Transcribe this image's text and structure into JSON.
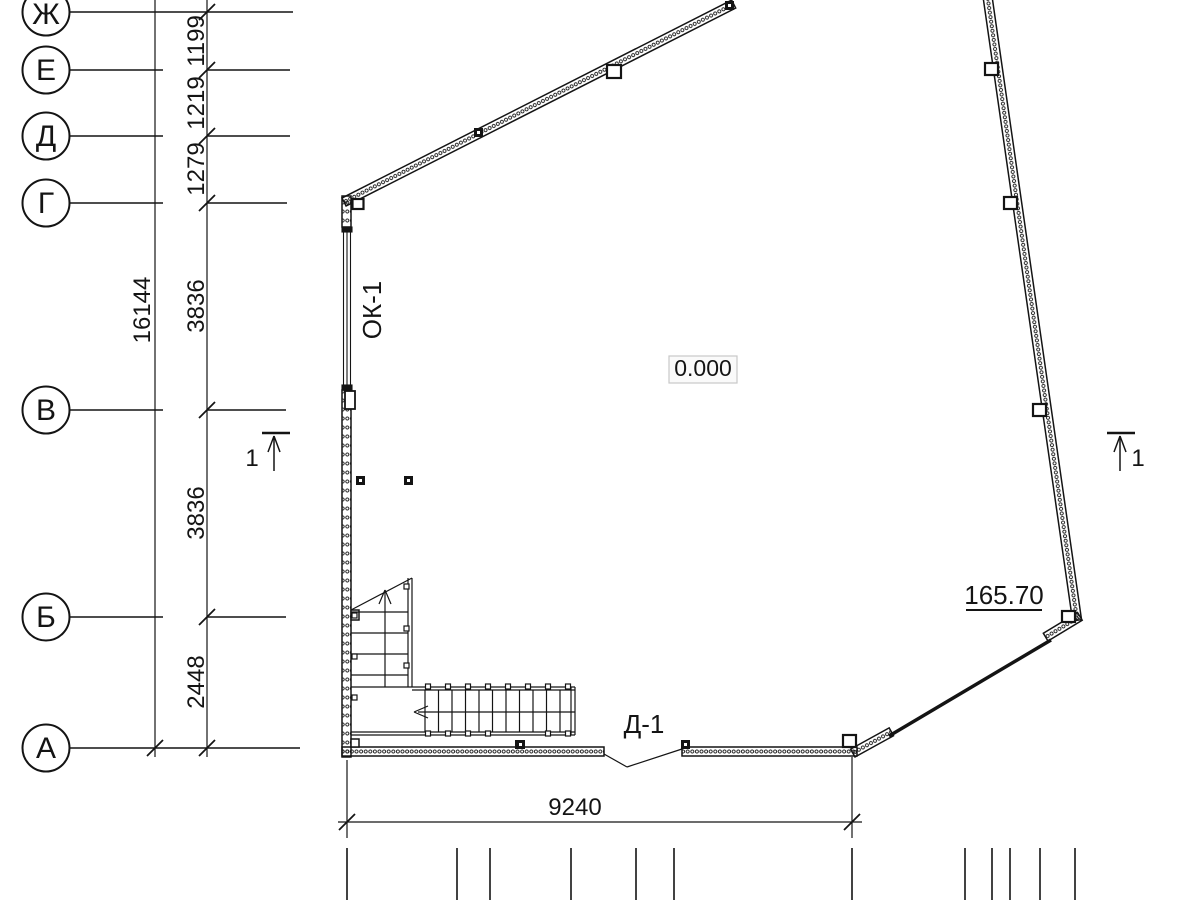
{
  "drawing": {
    "axes": [
      {
        "label": "Ж"
      },
      {
        "label": "Е"
      },
      {
        "label": "Д"
      },
      {
        "label": "Г"
      },
      {
        "label": "В"
      },
      {
        "label": "Б"
      },
      {
        "label": "А"
      }
    ],
    "dims": {
      "overall_left": "16144",
      "seg_zh_e": "1199",
      "seg_e_d": "1219",
      "seg_d_g": "1279",
      "seg_g_v": "3836",
      "seg_v_b": "3836",
      "seg_b_a": "2448",
      "bottom": "9240"
    },
    "marks": {
      "window": "ОК-1",
      "door": "Д-1",
      "level": "0.000",
      "elevation": "165.70",
      "section": "1"
    },
    "colors": {
      "ink": "#141414",
      "level_box_border": "#c8c8c8",
      "level_box_fill": "#fafafa"
    }
  }
}
